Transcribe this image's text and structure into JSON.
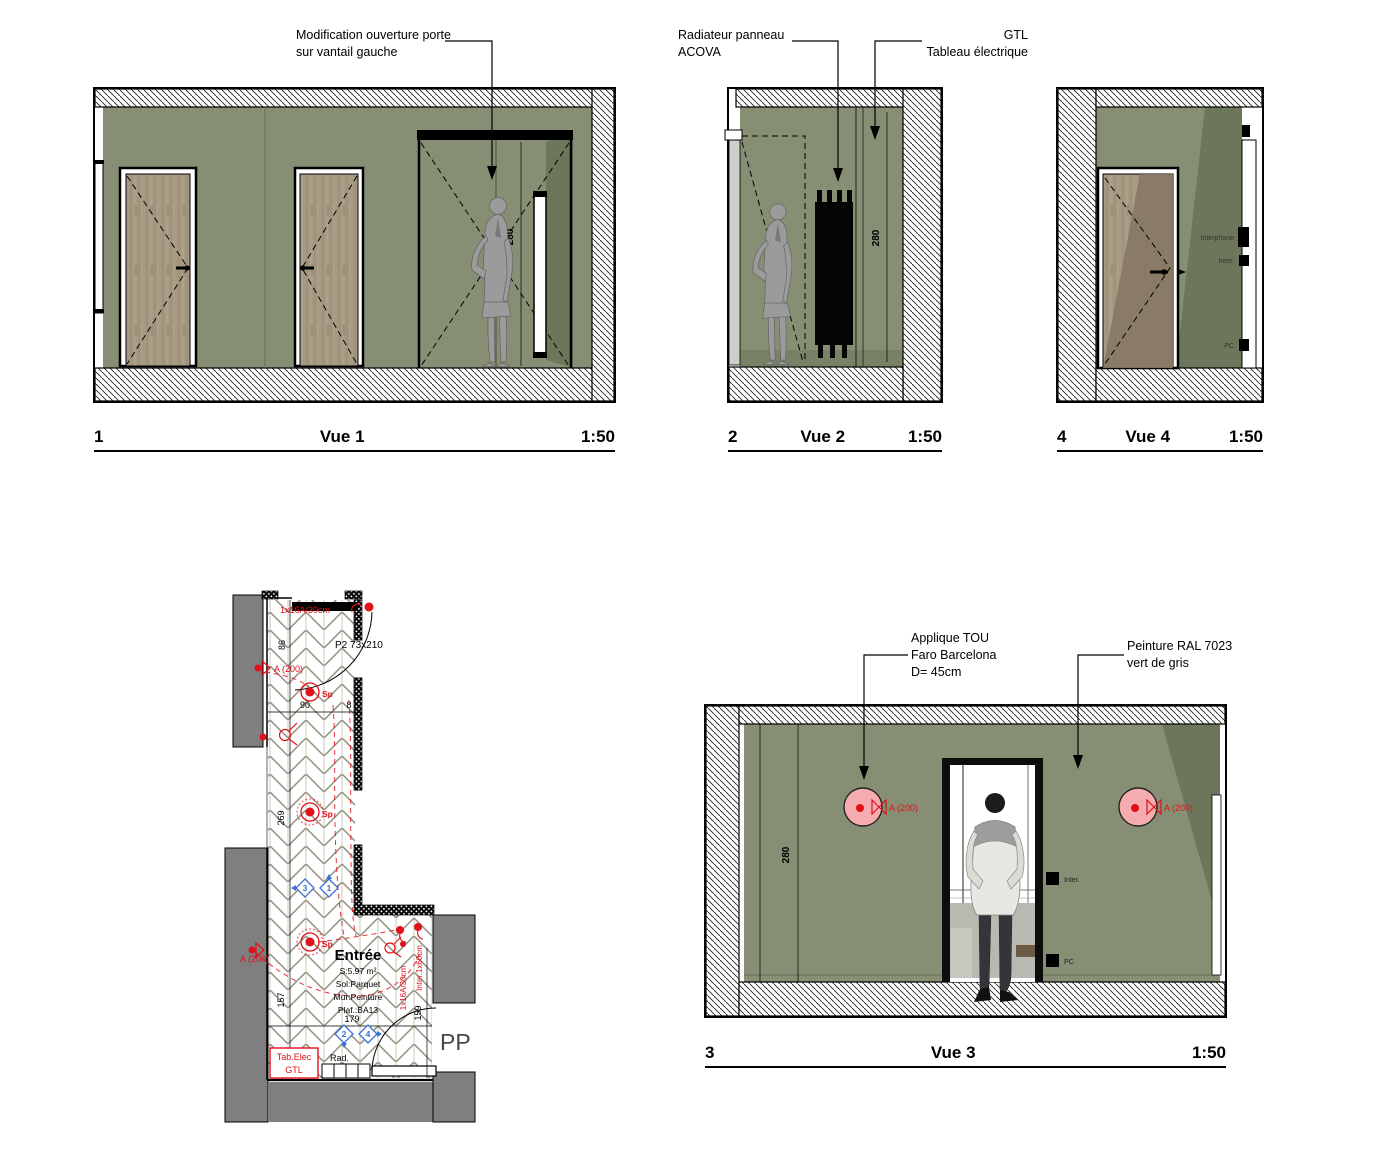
{
  "palette": {
    "wall_green": "#868F74",
    "wall_green_dark": "#6C765B",
    "wood": "#A79A82",
    "wood_dark": "#847663",
    "gray_wall": "#7F7F7F",
    "red": "#E31019",
    "pink": "#F5ACB0",
    "blue": "#3A6FD8"
  },
  "views": {
    "vue1": {
      "num": "1",
      "title": "Vue 1",
      "scale": "1:50",
      "dim": "280",
      "note": "Modification ouverture porte\nsur vantail gauche"
    },
    "vue2": {
      "num": "2",
      "title": "Vue 2",
      "scale": "1:50",
      "dim": "280",
      "note_radiator": "Radiateur panneau\nACOVA",
      "note_gtl": "GTL\nTableau électrique"
    },
    "vue3": {
      "num": "3",
      "title": "Vue 3",
      "scale": "1:50",
      "dim": "280",
      "note_applique": "Applique TOU\nFaro Barcelona\nD= 45cm",
      "note_paint": "Peinture RAL 7023\nvert de gris",
      "applique_label": "A (200)",
      "label_inter": "Inter.",
      "label_pc": "PC"
    },
    "vue4": {
      "num": "4",
      "title": "Vue 4",
      "scale": "1:50",
      "label_interphone": "Interphone",
      "label_inter": "Inter.",
      "label_pc": "PC"
    }
  },
  "plan": {
    "socket_top": "1x16A/30cm",
    "door_label": "P2 73x210",
    "dim_86": "86",
    "dim_90": "90",
    "dim_8": "8",
    "dim_269": "269",
    "dim_157": "157",
    "dim_179": "179",
    "dim_159": "159",
    "applique_label": "A (200)",
    "spot_label": "Sp",
    "room_name": "Entrée",
    "room_area": "S:5.97 m²",
    "room_floor": "Sol:Parquet",
    "room_wall": "Mur:Peinture",
    "room_ceiling": "Plaf.:BA13",
    "socket_right": "1x16A/30cm",
    "inter_right": "Inter.1x60cm",
    "tab_elec_line1": "Tab.Elec",
    "tab_elec_line2": "GTL",
    "rad_label": "Rad.",
    "pp_label": "PP",
    "marker_1": "1",
    "marker_2": "2",
    "marker_3": "3",
    "marker_4": "4"
  }
}
